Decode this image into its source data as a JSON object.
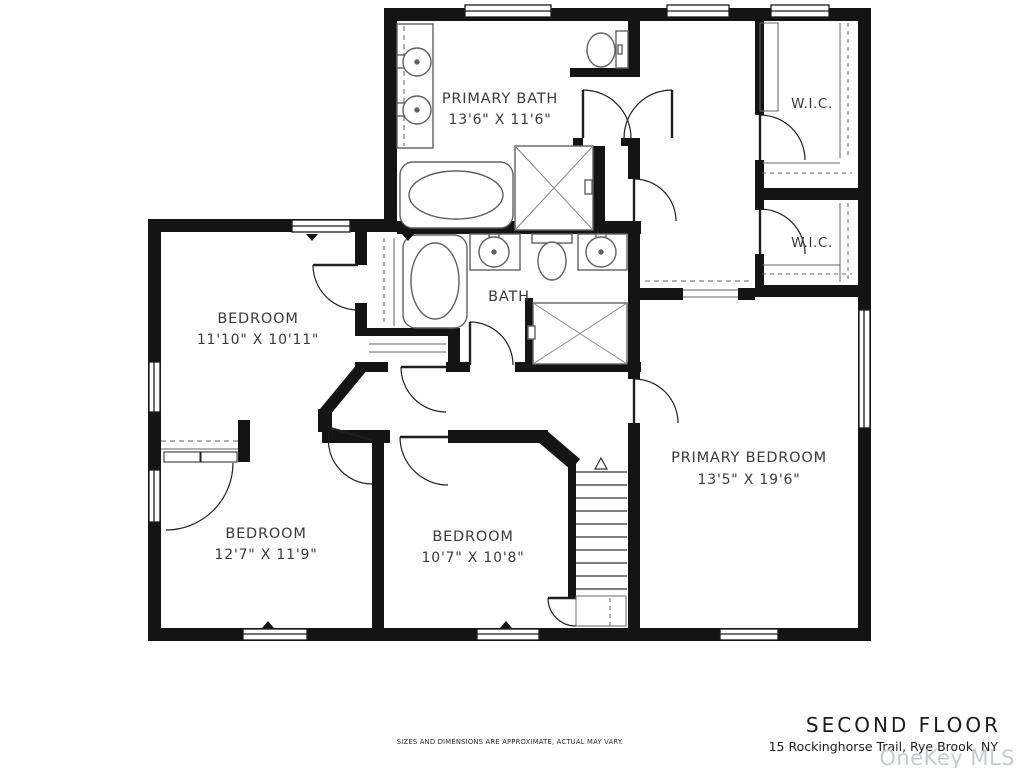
{
  "meta": {
    "background_color": "#ffffff",
    "wall_color": "#141414",
    "fixture_line_color": "#606060",
    "watermark_color": "#c7cbd1"
  },
  "rooms": {
    "primary_bath": {
      "name": "PRIMARY BATH",
      "dims": "13'6\" X 11'6\""
    },
    "wic_top": {
      "name": "W.I.C."
    },
    "wic_bottom": {
      "name": "W.I.C."
    },
    "bath": {
      "name": "BATH"
    },
    "bedroom_upper_left": {
      "name": "BEDROOM",
      "dims": "11'10\" X 10'11\""
    },
    "bedroom_lower_left": {
      "name": "BEDROOM",
      "dims": "12'7\" X 11'9\""
    },
    "bedroom_lower_middle": {
      "name": "BEDROOM",
      "dims": "10'7\" X 10'8\""
    },
    "primary_bedroom": {
      "name": "PRIMARY BEDROOM",
      "dims": "13'5\" X 19'6\""
    }
  },
  "footer": {
    "floor_title": "SECOND FLOOR",
    "address": "15 Rockinghorse Trail, Rye Brook, NY",
    "watermark": "OneKey MLS",
    "disclaimer": "SIZES AND DIMENSIONS ARE APPROXIMATE, ACTUAL MAY VARY."
  }
}
